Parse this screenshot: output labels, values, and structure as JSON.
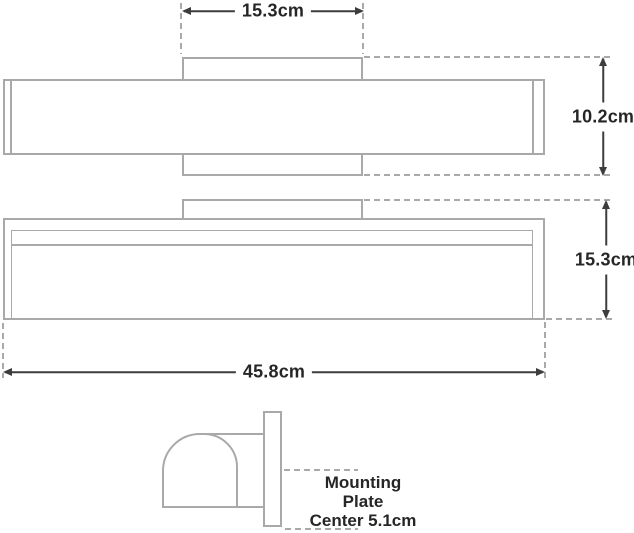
{
  "diagram": {
    "labels": {
      "backplate_width": "15.3cm",
      "fixture_depth": "10.2cm",
      "fixture_height": "15.3cm",
      "fixture_width": "45.8cm",
      "mounting_note_line1": "Mounting",
      "mounting_note_line2": "Plate",
      "mounting_note_line3": "Center 5.1cm"
    },
    "colors": {
      "fixture_outline": "#a9a9a9",
      "dimension_lines": "#3d3d3d",
      "label_text": "#262626",
      "background": "#ffffff"
    }
  }
}
